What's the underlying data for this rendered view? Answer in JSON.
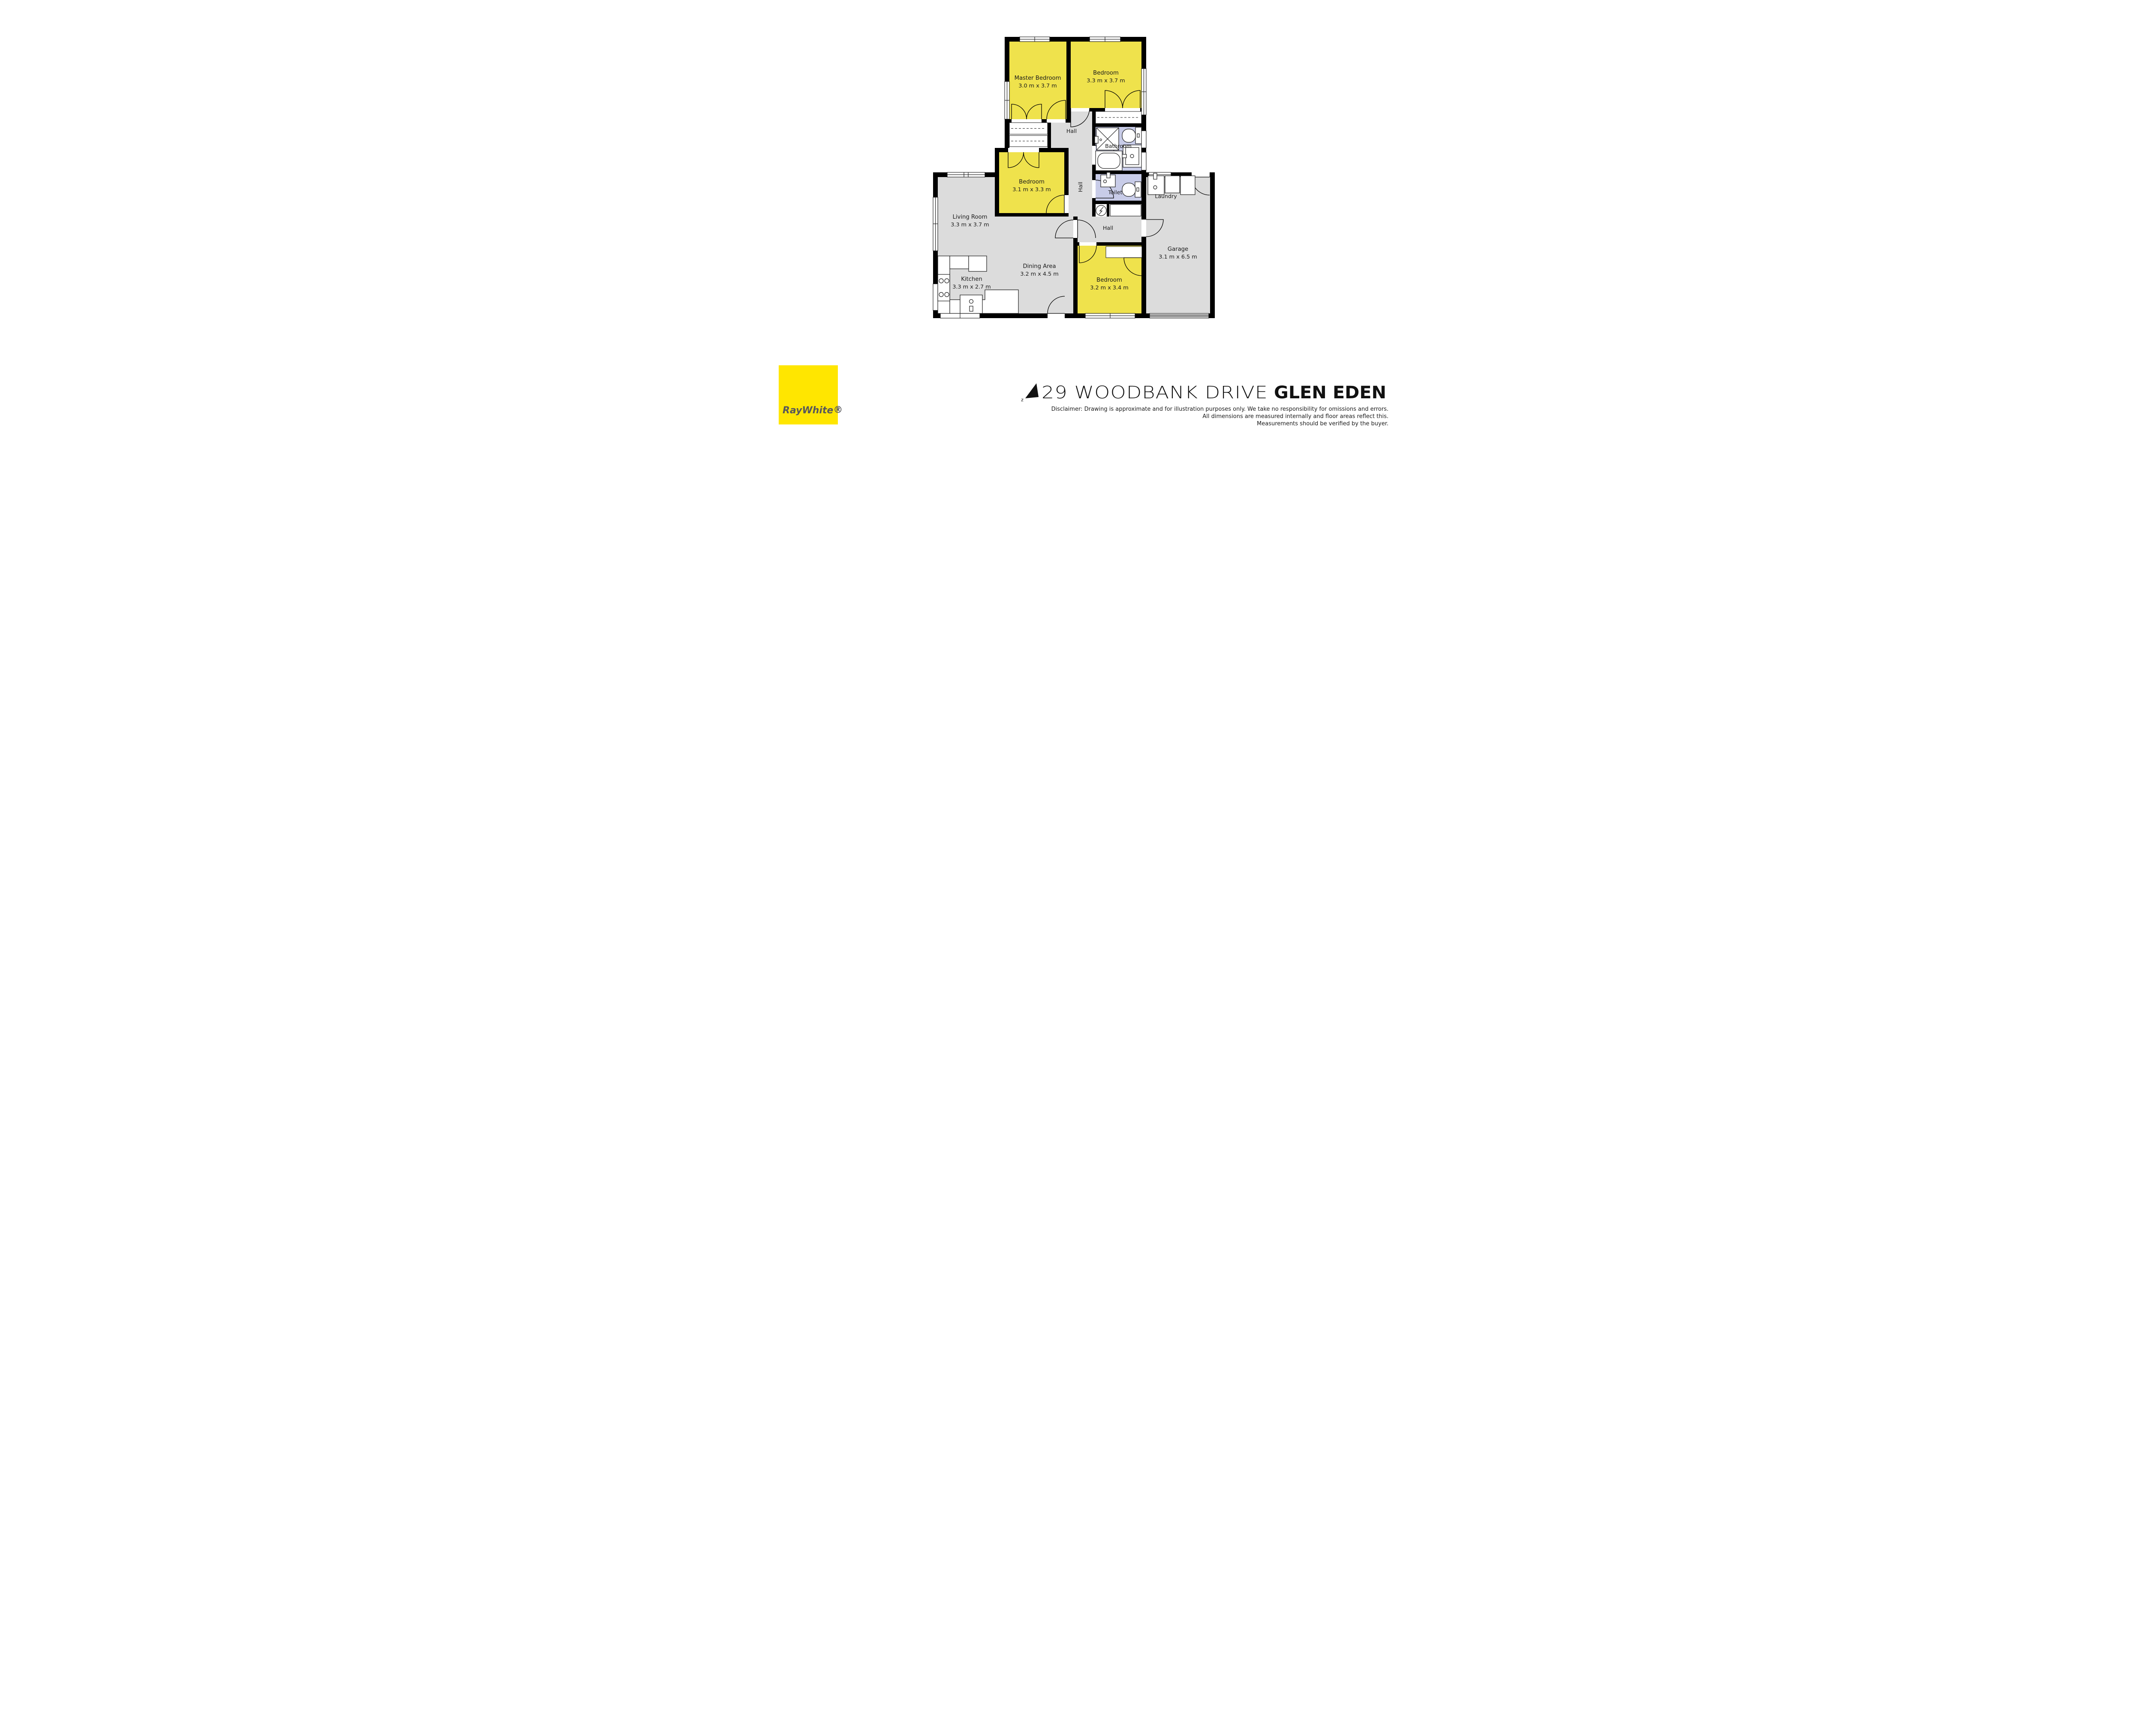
{
  "colors": {
    "room_yellow": "#EFE24C",
    "floor_gray": "#DCDCDC",
    "wet_lavender": "#C8CCE8",
    "wall_black": "#000000",
    "logo_yellow": "#FFE600",
    "logo_text_gray": "#58585B"
  },
  "rooms": {
    "master": {
      "name": "Master Bedroom",
      "dims": "3.0 m x 3.7 m"
    },
    "bed2": {
      "name": "Bedroom",
      "dims": "3.3 m x 3.7 m"
    },
    "bed3": {
      "name": "Bedroom",
      "dims": "3.1 m x 3.3 m"
    },
    "bed4": {
      "name": "Bedroom",
      "dims": "3.2 m x 3.4 m"
    },
    "living": {
      "name": "Living Room",
      "dims": "3.3 m x 3.7 m"
    },
    "dining": {
      "name": "Dining Area",
      "dims": "3.2 m x 4.5 m"
    },
    "kitchen": {
      "name": "Kitchen",
      "dims": "3.3 m x 2.7 m"
    },
    "garage": {
      "name": "Garage",
      "dims": "3.1 m x 6.5 m"
    },
    "bathroom": {
      "name": "Bathroom"
    },
    "toilet": {
      "name": "Toilet"
    },
    "laundry": {
      "name": "Laundry"
    },
    "hall_top": {
      "name": "Hall"
    },
    "hall_mid": {
      "name": "Hall"
    },
    "hall_lower": {
      "name": "Hall"
    }
  },
  "footer": {
    "north_label": "z",
    "address_street": "29 WOODBANK DRIVE",
    "address_suburb": "GLEN EDEN",
    "disclaimer_lines": [
      "Disclaimer: Drawing is approximate and for illustration purposes only. We take no responsibility for omissions and errors.",
      "All dimensions are measured internally and floor areas reflect this.",
      "Measurements should be verified by the buyer."
    ],
    "logo_brand": "RayWhite",
    "logo_reg": "®"
  }
}
